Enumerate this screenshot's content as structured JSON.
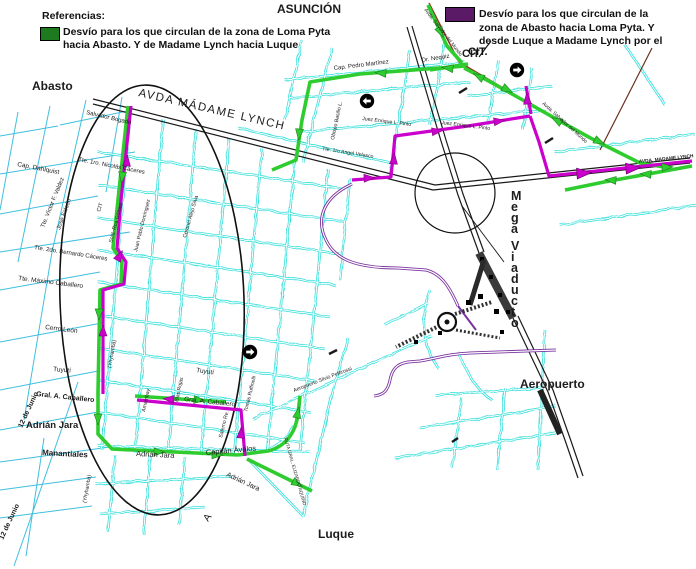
{
  "colors": {
    "legend_green": "#1E7A1E",
    "legend_purple": "#5B1A66",
    "route_green": "#2ECC2E",
    "route_magenta": "#CC00CC",
    "street_cyan": "#35DFDA",
    "street_cyan_light": "#3FBFDF",
    "ramp_purple": "#7B35A0",
    "road_black": "#1a1a1a",
    "road_brown": "#8B3522"
  },
  "legend_left": {
    "title": "Referencias:",
    "lines": [
      "Desvío para los que circulan de la zona de Loma Pyta",
      "hacia Abasto. Y de Madame Lynch hacia Luque"
    ]
  },
  "legend_right": {
    "lines": [
      "Desvío para los que circulan de la",
      "zona de Abasto hacia Loma Pyta. Y",
      "desde Luque a Madame Lynch por el",
      "CIT."
    ]
  },
  "map": {
    "labels": [
      {
        "t": "ASUNCIÓN",
        "x": 277,
        "y": 13,
        "r": 0,
        "s": 12,
        "w": true
      },
      {
        "t": "Abasto",
        "x": 32,
        "y": 90,
        "r": 0,
        "s": 12,
        "w": true
      },
      {
        "t": "Aeropuerto",
        "x": 520,
        "y": 388,
        "r": 0,
        "s": 12,
        "w": true
      },
      {
        "t": "Luque",
        "x": 318,
        "y": 538,
        "r": 0,
        "s": 12,
        "w": true
      },
      {
        "t": "Adrián Jara",
        "x": 26,
        "y": 428,
        "r": 0,
        "s": 9.5,
        "w": true
      },
      {
        "t": "Manantiales",
        "x": 42,
        "y": 455,
        "r": 3,
        "s": 8,
        "w": true
      },
      {
        "t": "Gral. A. Caballero",
        "x": 36,
        "y": 396,
        "r": 6,
        "s": 7,
        "w": true
      },
      {
        "t": "12 de Junio",
        "x": 22,
        "y": 428,
        "r": -65,
        "s": 7,
        "w": true
      },
      {
        "t": "12 de Junio",
        "x": 3,
        "y": 540,
        "r": -65,
        "s": 7,
        "w": true
      },
      {
        "t": "AVDA MÁDAME LYNCH",
        "x": 138,
        "y": 96,
        "r": 13,
        "s": 11.5,
        "w": false,
        "sp": 1.5
      },
      {
        "t": "AVDA. MADAME LYNCH",
        "x": 639,
        "y": 163,
        "r": -6,
        "s": 4.8,
        "w": true
      },
      {
        "t": "Salvador Bogado",
        "x": 86,
        "y": 114,
        "r": 13,
        "s": 6,
        "w": false
      },
      {
        "t": "Cap. Dahlquist",
        "x": 17,
        "y": 166,
        "r": 11,
        "s": 6.5,
        "w": false
      },
      {
        "t": "Tte. 1ro. Nicolás Cáceres",
        "x": 78,
        "y": 161,
        "r": 11,
        "s": 6,
        "w": false
      },
      {
        "t": "Tte. Víctor F. Valdez",
        "x": 44,
        "y": 228,
        "r": -68,
        "s": 6,
        "w": false
      },
      {
        "t": "José Falcón",
        "x": 60,
        "y": 230,
        "r": -70,
        "s": 6,
        "w": false
      },
      {
        "t": "Tte. 2do. Bernardo Cáceres",
        "x": 34,
        "y": 249,
        "r": 9,
        "s": 6,
        "w": false
      },
      {
        "t": "Tte. Máximo Caballero",
        "x": 18,
        "y": 280,
        "r": 7,
        "s": 6.5,
        "w": false
      },
      {
        "t": "Cerro León",
        "x": 45,
        "y": 329,
        "r": 7,
        "s": 6.5,
        "w": false
      },
      {
        "t": "Tuyutí",
        "x": 53,
        "y": 371,
        "r": 5,
        "s": 6.5,
        "w": false
      },
      {
        "t": "Tuyutí",
        "x": 196,
        "y": 372,
        "r": 8,
        "s": 6.5,
        "w": false
      },
      {
        "t": "Gral. A. Caballero",
        "x": 184,
        "y": 401,
        "r": 6,
        "s": 6.5,
        "w": false
      },
      {
        "t": "Adrián Jara",
        "x": 136,
        "y": 456,
        "r": 3,
        "s": 7.5,
        "w": false
      },
      {
        "t": "Capitán Ávalos",
        "x": 206,
        "y": 455,
        "r": -5,
        "s": 7.5,
        "w": false
      },
      {
        "t": "Adrián Jara",
        "x": 226,
        "y": 476,
        "r": 25,
        "s": 7,
        "w": false
      },
      {
        "t": "RUTA GRAL. ELIZARDO AQUINO",
        "x": 284,
        "y": 438,
        "r": 74,
        "s": 4.6,
        "w": false
      },
      {
        "t": "Aeropuerto Silvio Pettirossi",
        "x": 294,
        "y": 392,
        "r": -21,
        "s": 5.2,
        "w": false
      },
      {
        "t": "Tomás Ruffinelli",
        "x": 247,
        "y": 412,
        "r": -76,
        "s": 5.2,
        "w": false
      },
      {
        "t": "Salerno Re.",
        "x": 222,
        "y": 438,
        "r": -76,
        "s": 5.2,
        "w": false
      },
      {
        "t": "Blas Rojas",
        "x": 178,
        "y": 402,
        "r": -78,
        "s": 5.2,
        "w": false
      },
      {
        "t": "Amambay",
        "x": 145,
        "y": 412,
        "r": -78,
        "s": 5.2,
        "w": false
      },
      {
        "t": "(Yhyhambá)",
        "x": 86,
        "y": 503,
        "r": -80,
        "s": 5.2,
        "w": false
      },
      {
        "t": "(Yhyhambá)",
        "x": 111,
        "y": 368,
        "r": -80,
        "s": 5.2,
        "w": false
      },
      {
        "t": "CIT",
        "x": 100,
        "y": 212,
        "r": -72,
        "s": 5.5,
        "w": false
      },
      {
        "t": "Sold. Roa Gómez",
        "x": 112,
        "y": 243,
        "r": -75,
        "s": 5.2,
        "w": false
      },
      {
        "t": "Juan Pablo Domínguez",
        "x": 137,
        "y": 252,
        "r": -76,
        "s": 5.2,
        "w": false
      },
      {
        "t": "Coronel Alejo Silva",
        "x": 186,
        "y": 238,
        "r": -74,
        "s": 5.2,
        "w": false
      },
      {
        "t": "Cap. Pedro Martínez",
        "x": 334,
        "y": 70,
        "r": -7,
        "s": 6,
        "w": false
      },
      {
        "t": "Dr. Nequiz",
        "x": 422,
        "y": 62,
        "r": -9,
        "s": 6,
        "w": false
      },
      {
        "t": "Obispo Basilio L.",
        "x": 334,
        "y": 140,
        "r": -78,
        "s": 5.2,
        "w": false
      },
      {
        "t": "Tte. 1ro Angel Velasco",
        "x": 322,
        "y": 150,
        "r": 9,
        "s": 5.2,
        "w": false
      },
      {
        "t": "Juez Enrique L. Pinto",
        "x": 362,
        "y": 120,
        "r": 7,
        "s": 5.2,
        "w": false
      },
      {
        "t": "Juez Enrique L. Pinto",
        "x": 441,
        "y": 124,
        "r": 7,
        "s": 5.2,
        "w": false
      },
      {
        "t": "Avda. Salvador del Mundo",
        "x": 424,
        "y": 10,
        "r": 52,
        "s": 5,
        "w": false
      },
      {
        "t": "Avda. Salvador del Mundo",
        "x": 542,
        "y": 104,
        "r": 42,
        "s": 5,
        "w": false
      },
      {
        "t": "CIT",
        "x": 462,
        "y": 57,
        "r": 0,
        "s": 11,
        "w": true
      },
      {
        "t": "Mega Viaducto",
        "x": 511,
        "y": 200,
        "r": 0,
        "s": 12.5,
        "w": true,
        "st": true
      },
      {
        "t": "A",
        "x": 208,
        "y": 522,
        "r": -55,
        "s": 10,
        "w": false
      }
    ],
    "badges": [
      {
        "x": 367,
        "y": 101,
        "rot": 180
      },
      {
        "x": 517,
        "y": 70,
        "rot": 0
      },
      {
        "x": 250,
        "y": 352,
        "rot": 0
      }
    ]
  }
}
